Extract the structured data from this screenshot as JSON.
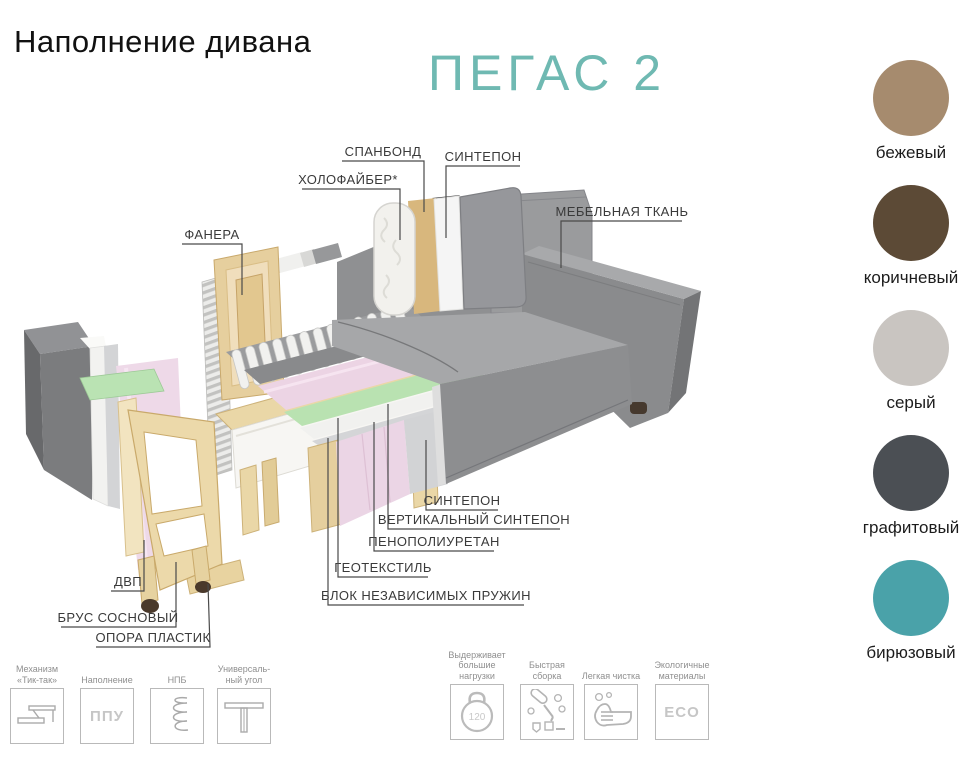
{
  "page": {
    "title": "Наполнение дивана",
    "product_name": "ПЕГАС 2",
    "accent_color": "#6fb9b2"
  },
  "diagram": {
    "labels": {
      "spunbond": "СПАНБОНД",
      "sintepon_top": "СИНТЕПОН",
      "holofiber": "ХОЛОФАЙБЕР*",
      "furniture_fabric": "МЕБЕЛЬНАЯ ТКАНЬ",
      "plywood": "ФАНЕРА",
      "sintepon_seat": "СИНТЕПОН",
      "vertical_sintepon": "ВЕРТИКАЛЬНЫЙ СИНТЕПОН",
      "polyurethane_foam": "ПЕНОПОЛИУРЕТАН",
      "geotextile": "ГЕОТЕКСТИЛЬ",
      "independent_springs": "БЛОК НЕЗАВИСИМЫХ ПРУЖИН",
      "fiberboard": "ДВП",
      "pine_timber": "БРУС СОСНОВЫЙ",
      "plastic_support": "ОПОРА ПЛАСТИК"
    }
  },
  "colors": [
    {
      "name": "бежевый",
      "hex": "#a68b6e"
    },
    {
      "name": "коричневый",
      "hex": "#5c4a36"
    },
    {
      "name": "серый",
      "hex": "#c9c5c1"
    },
    {
      "name": "графитовый",
      "hex": "#4b4f54"
    },
    {
      "name": "бирюзовый",
      "hex": "#4aa2a9"
    }
  ],
  "features": [
    {
      "label": "Механизм\n«Тик-так»",
      "icon": "tiktak-mechanism"
    },
    {
      "label": "Наполнение",
      "icon": "ppu-filling",
      "icon_text": "ППУ"
    },
    {
      "label": "НПБ",
      "icon": "spring"
    },
    {
      "label": "Универсаль-\nный угол",
      "icon": "universal-corner"
    },
    {
      "label": "Выдерживает\nбольшие\nнагрузки",
      "icon": "kettlebell",
      "icon_text": "120"
    },
    {
      "label": "Быстрая\nсборка",
      "icon": "quick-assembly"
    },
    {
      "label": "Легкая чистка",
      "icon": "easy-cleaning"
    },
    {
      "label": "Экологичные\nматериалы",
      "icon": "eco",
      "icon_text": "ECO"
    }
  ]
}
